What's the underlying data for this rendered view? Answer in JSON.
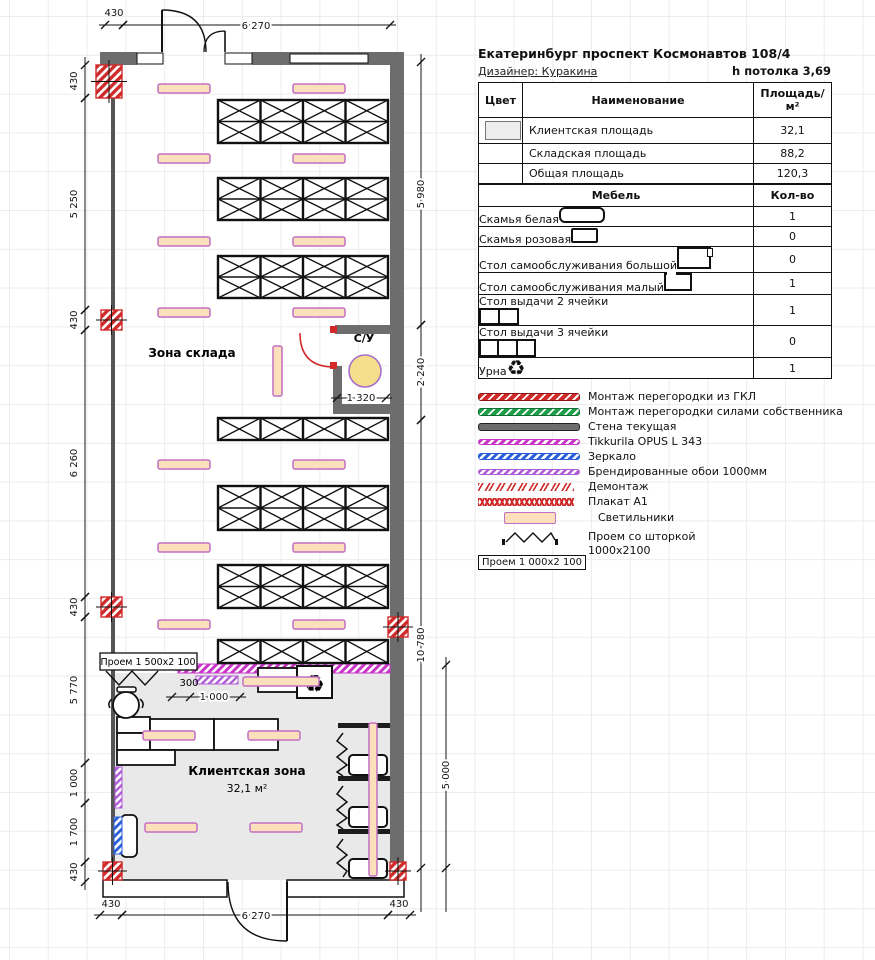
{
  "header": {
    "title": "Екатеринбург проспект Космонавтов 108/4",
    "designer": "Дизайнер: Куракина",
    "ceiling": "h потолка 3,69"
  },
  "area_table": {
    "col_color": "Цвет",
    "col_name": "Наименование",
    "col_area": "Площадь/м²",
    "rows": [
      {
        "name": "Клиентская площадь",
        "area": "32,1",
        "swatch": "#ededed"
      },
      {
        "name": "Складская площадь",
        "area": "88,2",
        "swatch": ""
      },
      {
        "name": "Общая площадь",
        "area": "120,3",
        "swatch": ""
      }
    ]
  },
  "furniture_table": {
    "col_name": "Мебель",
    "col_qty": "Кол-во",
    "rows": [
      {
        "name": "Скамья белая",
        "icon": "bench-white",
        "qty": "1"
      },
      {
        "name": "Скамья розовая",
        "icon": "bench-pink",
        "qty": "0"
      },
      {
        "name": "Стол самообслуживания большой",
        "icon": "self-table-big",
        "qty": "0"
      },
      {
        "name": "Стол самообслуживания малый",
        "icon": "self-table-small",
        "qty": "1"
      },
      {
        "name": "Стол выдачи 2 ячейки",
        "icon": "issue-table-2",
        "qty": "1"
      },
      {
        "name": "Стол выдачи 3 ячейки",
        "icon": "issue-table-3",
        "qty": "0"
      },
      {
        "name": "Урна",
        "icon": "urn",
        "qty": "1"
      }
    ]
  },
  "legend": {
    "items": [
      {
        "label": "Монтаж перегородки из ГКЛ",
        "type": "b-red"
      },
      {
        "label": "Монтаж перегородки силами собственника",
        "type": "b-green"
      },
      {
        "label": "Стена текущая",
        "type": "b-gray"
      },
      {
        "label": "Tikkurila OPUS L 343",
        "type": "b-mag"
      },
      {
        "label": "Зеркало",
        "type": "b-blue"
      },
      {
        "label": "Брендированные обои 1000мм",
        "type": "b-violet"
      },
      {
        "label": "Демонтаж",
        "type": "b-demo"
      },
      {
        "label": "Плакат А1",
        "type": "b-poster"
      },
      {
        "label": "Светильники",
        "type": "b-light"
      }
    ],
    "curtain_box": "Проем  1 000х2 100",
    "curtain_label1": "Проем со шторкой",
    "curtain_label2": "1000х2100"
  },
  "plan": {
    "labels": {
      "storage": "Зона склада",
      "wc": "С/У",
      "client": "Клиентская зона",
      "client_area": "32,1 м²",
      "opening_box": "Проем  1 500х2 100",
      "gap300": "300",
      "recycle": "♻"
    },
    "racks": {
      "x": 218,
      "w": 170,
      "cols": 4,
      "blocks": [
        {
          "y": 100,
          "h": 43,
          "rows": 2
        },
        {
          "y": 178,
          "h": 42,
          "rows": 2
        },
        {
          "y": 256,
          "h": 42,
          "rows": 2
        },
        {
          "y": 418,
          "h": 22,
          "rows": 1
        },
        {
          "y": 486,
          "h": 44,
          "rows": 2
        },
        {
          "y": 565,
          "h": 43,
          "rows": 2
        },
        {
          "y": 640,
          "h": 23,
          "rows": 1
        }
      ]
    },
    "lights_h": [
      [
        158,
        84
      ],
      [
        293,
        84
      ],
      [
        158,
        154
      ],
      [
        293,
        154
      ],
      [
        158,
        237
      ],
      [
        293,
        237
      ],
      [
        158,
        308
      ],
      [
        293,
        308
      ],
      [
        158,
        460
      ],
      [
        293,
        460
      ],
      [
        158,
        543
      ],
      [
        293,
        543
      ],
      [
        158,
        620
      ],
      [
        293,
        620
      ],
      [
        243,
        677,
        76,
        9
      ],
      [
        143,
        731
      ],
      [
        248,
        731
      ],
      [
        145,
        823
      ],
      [
        250,
        823
      ]
    ],
    "lights_v": [
      [
        273,
        346,
        9,
        50
      ],
      [
        369,
        723,
        8,
        153
      ]
    ],
    "columns": [
      [
        96,
        65,
        26,
        33
      ],
      [
        101,
        310,
        21,
        20
      ],
      [
        101,
        597,
        21,
        20
      ],
      [
        388,
        617,
        20,
        20
      ],
      [
        103,
        862,
        19,
        18
      ],
      [
        390,
        862,
        16,
        18
      ]
    ],
    "dims": [
      {
        "o": "h",
        "y": 25,
        "x1": 105,
        "x2": 123,
        "label": "430",
        "tx": 114,
        "ty": 16
      },
      {
        "o": "h",
        "y": 25,
        "x1": 123,
        "x2": 390,
        "label": "6 270",
        "tx": 256,
        "ty": 29,
        "halo": 1
      },
      {
        "o": "h",
        "y": 915,
        "x1": 100,
        "x2": 122,
        "label": "430",
        "tx": 111,
        "ty": 907
      },
      {
        "o": "h",
        "y": 915,
        "x1": 122,
        "x2": 388,
        "label": "6 270",
        "tx": 256,
        "ty": 919,
        "halo": 1
      },
      {
        "o": "h",
        "y": 915,
        "x1": 388,
        "x2": 410,
        "label": "430",
        "tx": 399,
        "ty": 907
      },
      {
        "o": "h",
        "y": 398,
        "x1": 337,
        "x2": 386,
        "label": "1 320",
        "tx": 361,
        "ty": 401,
        "halo": 1
      },
      {
        "o": "h",
        "y": 697,
        "x1": 172,
        "x2": 240,
        "label": "1 000",
        "tx": 214,
        "ty": 700,
        "halo": 1,
        "ticks": [
          190
        ]
      },
      {
        "o": "v",
        "x": 85,
        "y1": 65,
        "y2": 98,
        "label": "430",
        "tx": 77,
        "ty": 81
      },
      {
        "o": "v",
        "x": 85,
        "y1": 98,
        "y2": 310,
        "label": "5 250",
        "tx": 77,
        "ty": 204
      },
      {
        "o": "v",
        "x": 85,
        "y1": 310,
        "y2": 330,
        "label": "430",
        "tx": 77,
        "ty": 320
      },
      {
        "o": "v",
        "x": 85,
        "y1": 330,
        "y2": 597,
        "label": "6 260",
        "tx": 77,
        "ty": 463
      },
      {
        "o": "v",
        "x": 85,
        "y1": 597,
        "y2": 617,
        "label": "430",
        "tx": 77,
        "ty": 607
      },
      {
        "o": "v",
        "x": 85,
        "y1": 617,
        "y2": 763,
        "label": "5 770",
        "tx": 77,
        "ty": 690
      },
      {
        "o": "v",
        "x": 85,
        "y1": 763,
        "y2": 803,
        "label": "1 000",
        "tx": 77,
        "ty": 783
      },
      {
        "o": "v",
        "x": 85,
        "y1": 803,
        "y2": 862,
        "label": "1 700",
        "tx": 77,
        "ty": 832
      },
      {
        "o": "v",
        "x": 85,
        "y1": 862,
        "y2": 882,
        "label": "430",
        "tx": 77,
        "ty": 872
      },
      {
        "o": "v",
        "x": 421,
        "y1": 62,
        "y2": 325,
        "label": "5 980",
        "tx": 424,
        "ty": 194,
        "halo": 1
      },
      {
        "o": "v",
        "x": 421,
        "y1": 325,
        "y2": 420,
        "label": "2 240",
        "tx": 424,
        "ty": 372,
        "halo": 1
      },
      {
        "o": "v",
        "x": 421,
        "y1": 420,
        "y2": 868,
        "label": "10 780",
        "tx": 424,
        "ty": 645,
        "halo": 1,
        "ext2": 44
      },
      {
        "o": "v",
        "x": 446,
        "y1": 665,
        "y2": 868,
        "label": "5 000",
        "tx": 449,
        "ty": 775,
        "halo": 1,
        "ext2": 44
      }
    ]
  },
  "colors": {
    "wall": "#6d6d6d",
    "demolition_red": "#cf2b2b",
    "partition_magenta": "#c836c8",
    "wallpaper_violet": "#b05bd6",
    "mirror_blue": "#2b5fd9",
    "owner_green": "#1f9e4a",
    "light_fill": "#fbe0bb",
    "light_border": "#c36fc3",
    "wc_circle": "#f5df8d",
    "client_fill": "#e9e9e9"
  }
}
